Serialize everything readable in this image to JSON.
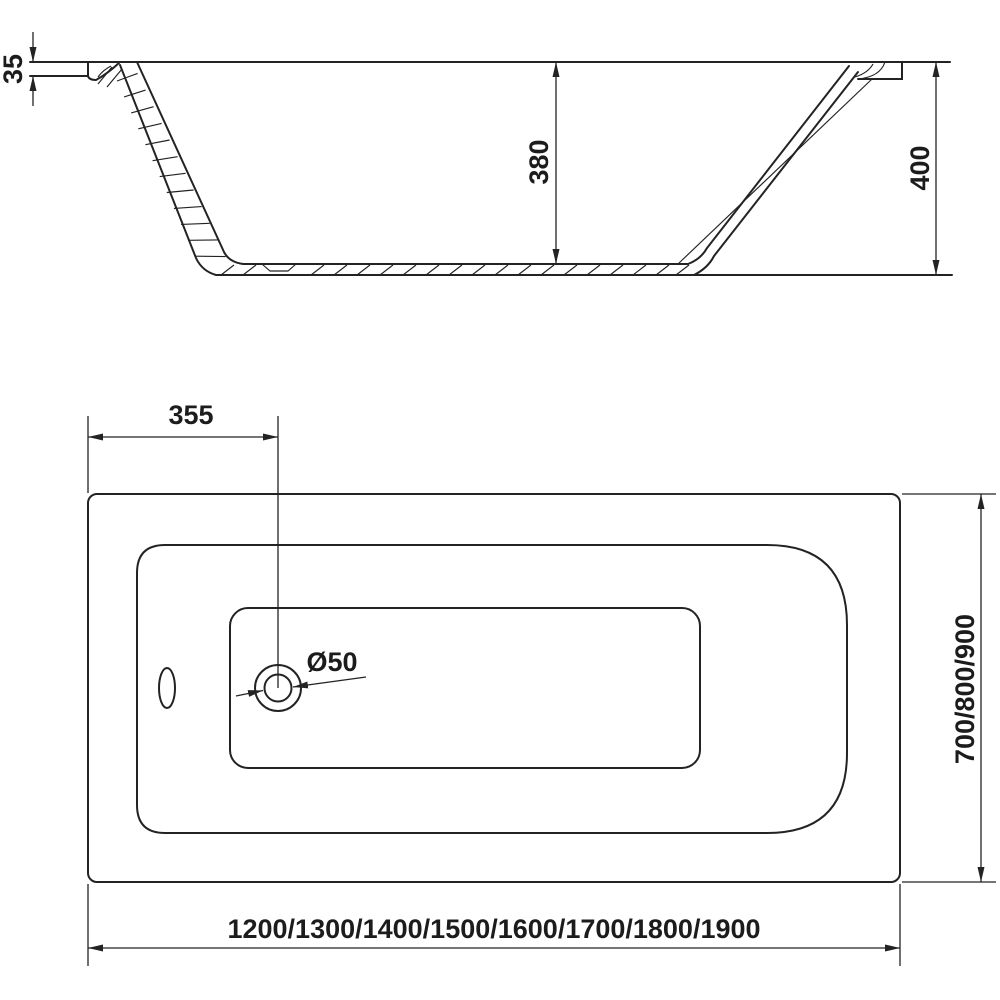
{
  "colors": {
    "background": "#ffffff",
    "line": "#232323",
    "text": "#1c1c1c"
  },
  "side_view": {
    "dimensions": {
      "rim_thickness": "35",
      "inner_depth": "380",
      "overall_height": "400"
    }
  },
  "top_view": {
    "dimensions": {
      "drain_offset": "355",
      "drain_diameter": "Ø50",
      "width_options": "700/800/900",
      "length_options": "1200/1300/1400/1500/1600/1700/1800/1900"
    }
  }
}
